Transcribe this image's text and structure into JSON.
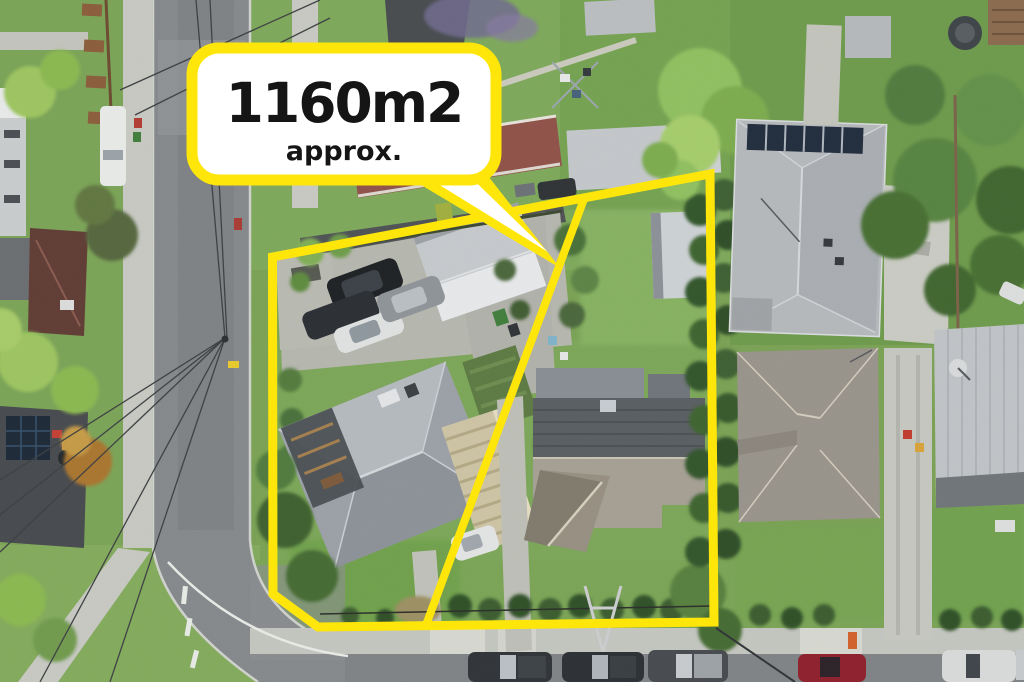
{
  "callout": {
    "area_label": "1160m2",
    "qualifier": "approx."
  },
  "colors": {
    "boundary_yellow": "#ffe60a",
    "callout_bg": "#ffffff",
    "callout_border": "#ffe60a",
    "callout_text": "#151515"
  },
  "scene": {
    "type": "aerial-drone-photo",
    "subject": "residential-property-lot-outline"
  }
}
